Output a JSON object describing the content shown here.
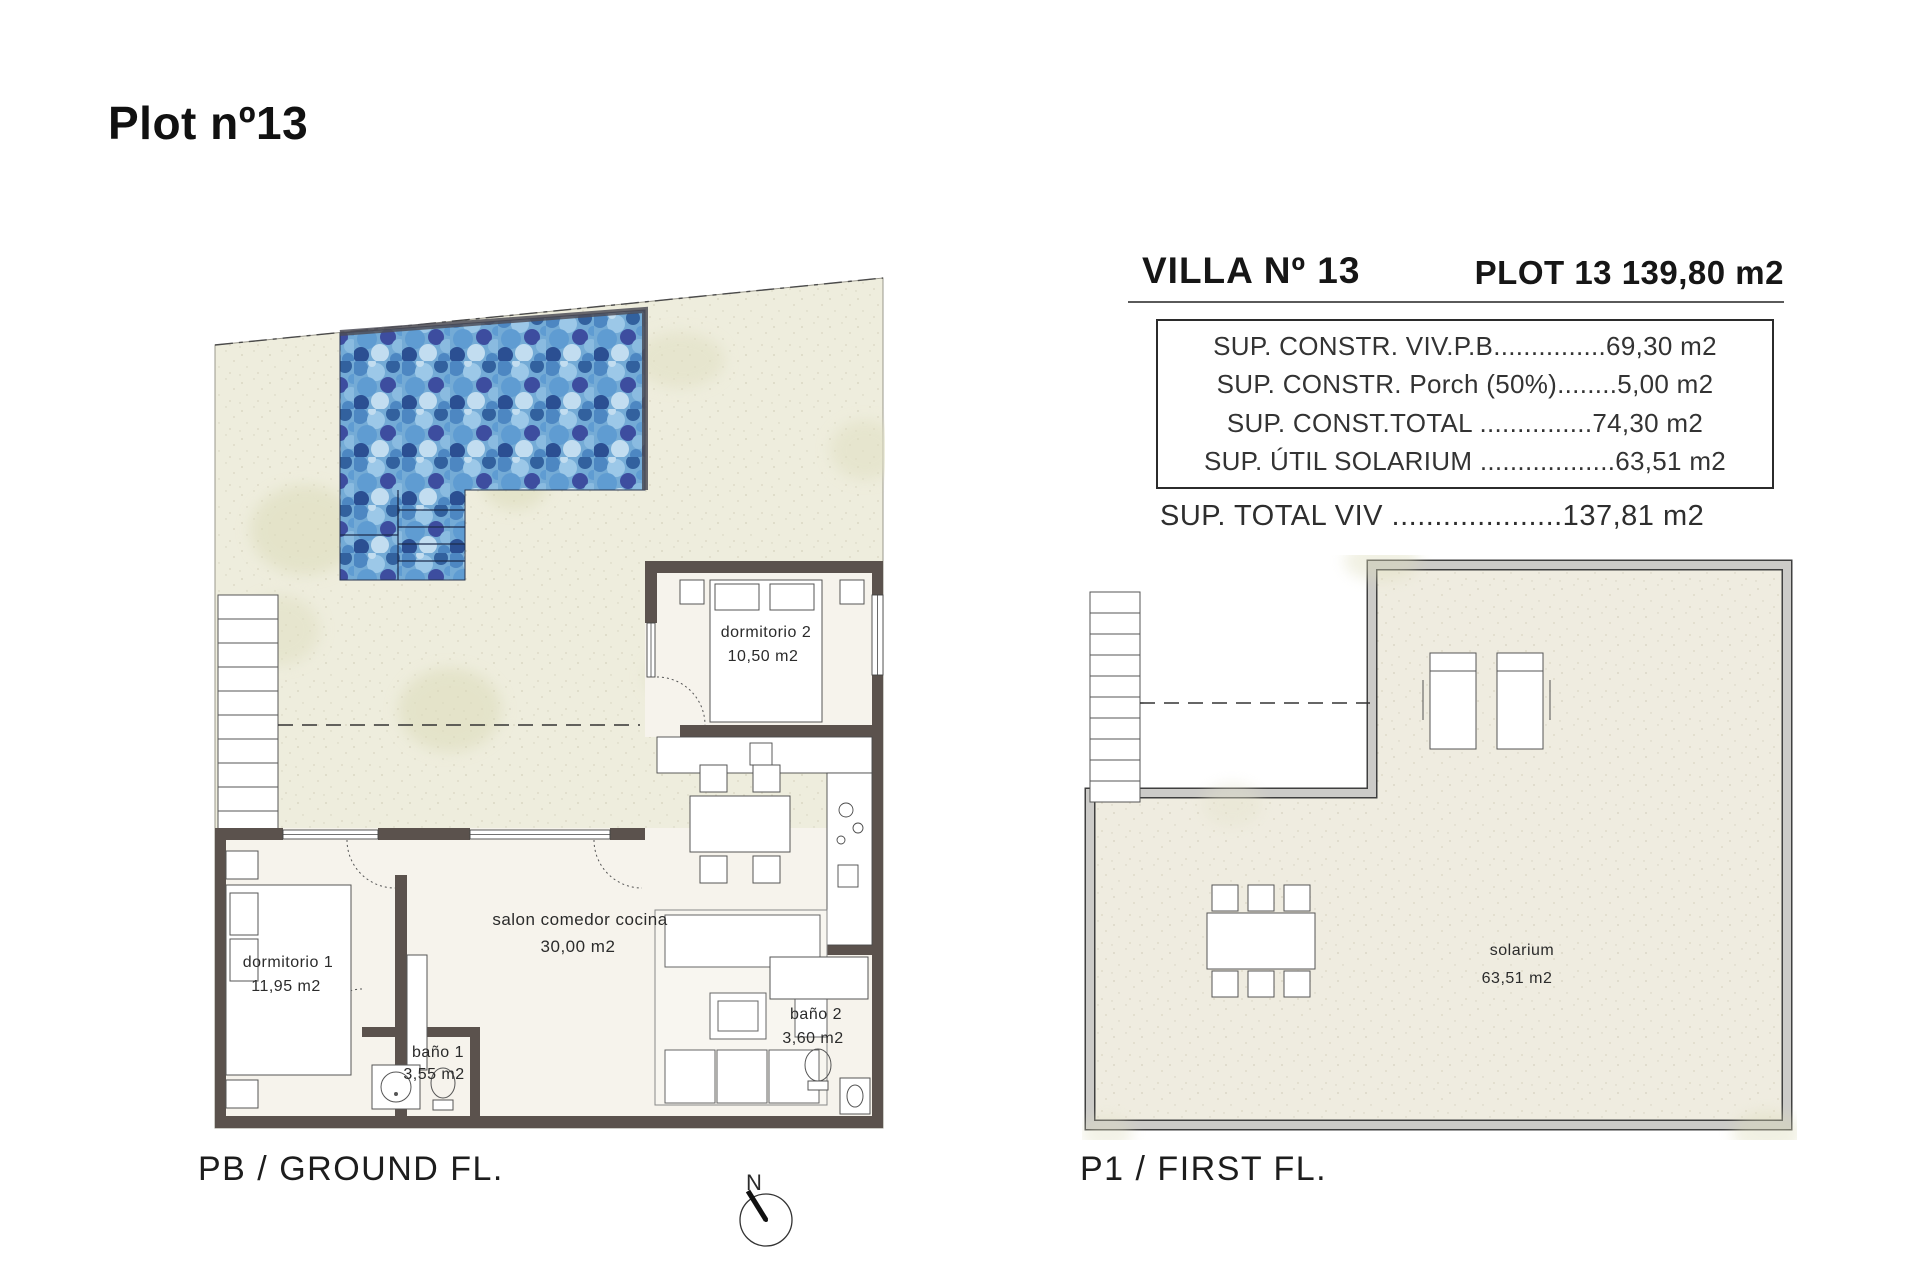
{
  "page": {
    "title": "Plot nº13"
  },
  "spec_panel": {
    "villa_title": "VILLA Nº 13",
    "plot_title": "PLOT 13 139,80 m2",
    "rows": [
      "SUP. CONSTR. VIV.P.B...............69,30 m2",
      "SUP. CONSTR. Porch (50%)........5,00 m2",
      "SUP. CONST.TOTAL ...............74,30 m2",
      "SUP. ÚTIL SOLARIUM ..................63,51 m2"
    ],
    "total_row": "SUP. TOTAL VIV ....................137,81 m2"
  },
  "ground_floor": {
    "caption": "PB / GROUND FL.",
    "rooms": {
      "dormitorio2": {
        "name": "dormitorio 2",
        "area": "10,50 m2"
      },
      "dormitorio1": {
        "name": "dormitorio 1",
        "area": "11,95 m2"
      },
      "salon": {
        "name": "salon comedor cocina",
        "area": "30,00 m2"
      },
      "bano1": {
        "name": "baño 1",
        "area": "3,55 m2"
      },
      "bano2": {
        "name": "baño 2",
        "area": "3,60 m2"
      }
    }
  },
  "first_floor": {
    "caption": "P1 / FIRST FL.",
    "rooms": {
      "solarium": {
        "name": "solarium",
        "area": "63,51 m2"
      }
    }
  },
  "compass": {
    "north_label": "N"
  },
  "colors": {
    "pool_water": "#74abd6",
    "wall_dark": "#5b524d",
    "terrain": "#f0eee2"
  }
}
